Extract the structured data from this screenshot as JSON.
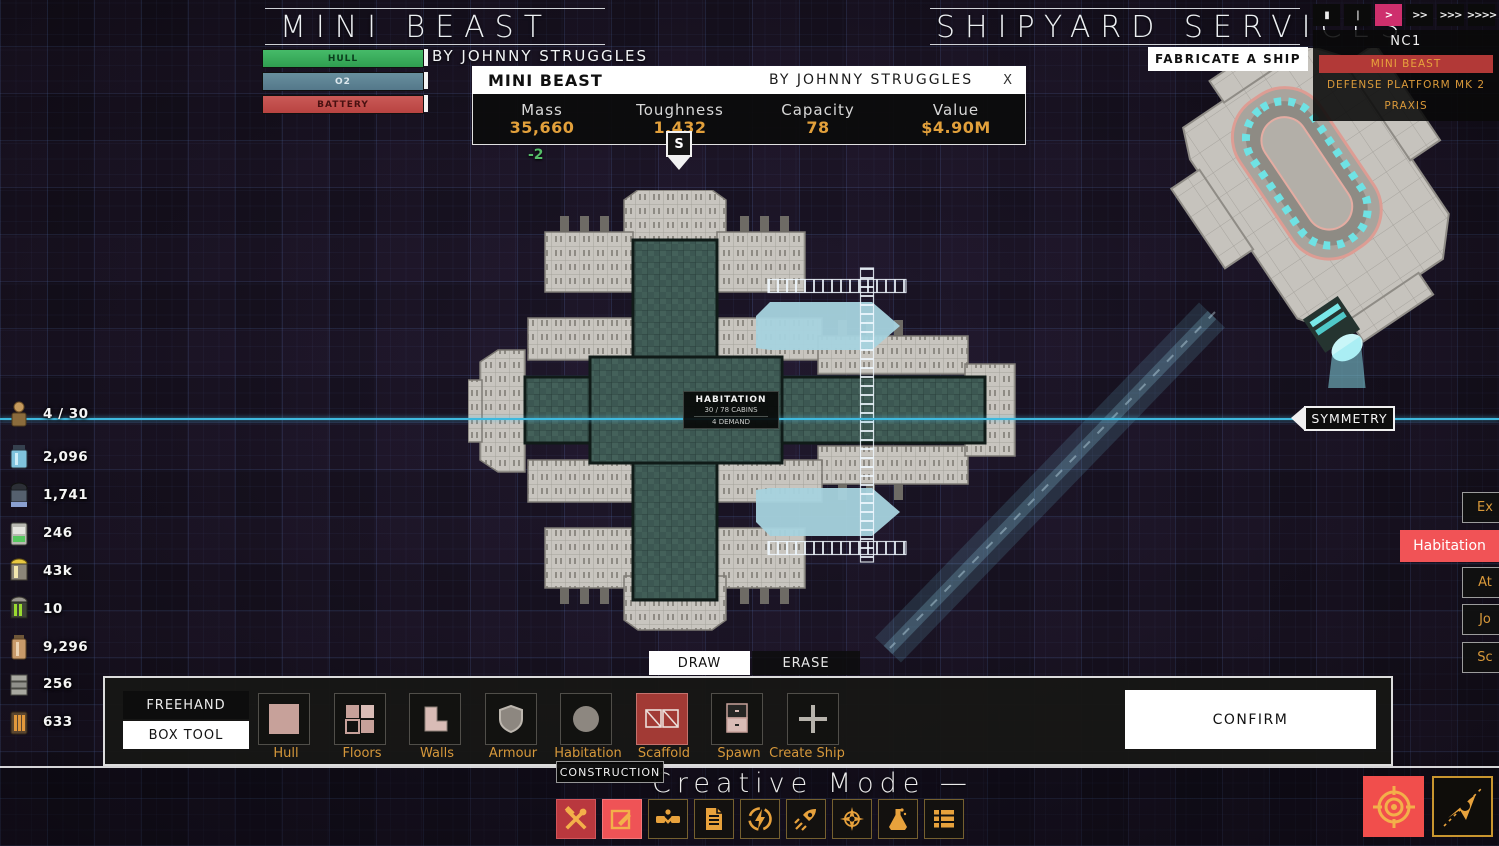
{
  "header": {
    "left_title": "MINI BEAST",
    "left_author": "BY JOHNNY STRUGGLES",
    "right_title": "SHIPYARD SERVICES",
    "fabricate": "FABRICATE A SHIP",
    "bars": [
      {
        "label": "HULL",
        "color": "#35a455"
      },
      {
        "label": "O2",
        "color": "#5a7e8e"
      },
      {
        "label": "BATTERY",
        "color": "#c04a49"
      }
    ]
  },
  "speed_controls": {
    "buttons": [
      {
        "glyph": "▮",
        "active": false
      },
      {
        "glyph": "|",
        "active": false
      },
      {
        "glyph": ">",
        "active": true
      },
      {
        "glyph": ">>",
        "active": false
      },
      {
        "glyph": ">>>",
        "active": false
      },
      {
        "glyph": ">>>>",
        "active": false
      }
    ],
    "active_color": "#ce2f6d"
  },
  "ship_list": {
    "title": "NC1",
    "items": [
      {
        "label": "MINI BEAST",
        "selected": true
      },
      {
        "label": "DEFENSE PLATFORM MK 2",
        "selected": false
      },
      {
        "label": "PRAXIS",
        "selected": false
      }
    ]
  },
  "info_dialog": {
    "title": "MINI BEAST",
    "author": "BY JOHNNY STRUGGLES",
    "close": "X",
    "stats": [
      {
        "label": "Mass",
        "value": "35,660"
      },
      {
        "label": "Toughness",
        "value": "1,432"
      },
      {
        "label": "Capacity",
        "value": "78"
      },
      {
        "label": "Value",
        "value": "$4.90M"
      }
    ],
    "delta": "-2"
  },
  "spawn_marker": "S",
  "resources": [
    {
      "icon": "crew-icon",
      "value": "4 / 30"
    },
    {
      "icon": "canister-blue-icon",
      "value": "2,096"
    },
    {
      "icon": "canister-dark-icon",
      "value": "1,741"
    },
    {
      "icon": "cell-green-icon",
      "value": "246"
    },
    {
      "icon": "barrel-yellow-icon",
      "value": "43k"
    },
    {
      "icon": "barrel-green-icon",
      "value": "10"
    },
    {
      "icon": "canister-tan-icon",
      "value": "9,296"
    },
    {
      "icon": "stack-gray-icon",
      "value": "256"
    },
    {
      "icon": "stack-orange-icon",
      "value": "633"
    }
  ],
  "symmetry_button": "SYMMETRY",
  "right_panel": {
    "habitation": "Habitation",
    "buttons": [
      {
        "label": "Ex"
      },
      {
        "label": "At"
      },
      {
        "label": "Jo"
      },
      {
        "label": "Sc"
      }
    ]
  },
  "ship_label": {
    "title": "HABITATION",
    "capacity": "30 / 78 CABINS",
    "demand": "4 DEMAND"
  },
  "draw_tabs": {
    "draw": "DRAW",
    "erase": "ERASE"
  },
  "toolbar": {
    "freehand": "FREEHAND",
    "box_tool": "BOX TOOL",
    "tools": [
      {
        "label": "Hull",
        "selected": false
      },
      {
        "label": "Floors",
        "selected": false
      },
      {
        "label": "Walls",
        "selected": false
      },
      {
        "label": "Armour",
        "selected": false
      },
      {
        "label": "Habitation",
        "selected": false
      },
      {
        "label": "Scaffold",
        "selected": true
      },
      {
        "label": "Spawn",
        "selected": false
      },
      {
        "label": "Create Ship",
        "selected": false
      }
    ],
    "confirm": "CONFIRM"
  },
  "tooltip": "CONSTRUCTION",
  "mode_text": "Creative Mode —",
  "bottom_icons": [
    {
      "name": "construction-tools-icon",
      "active": true
    },
    {
      "name": "draw-edit-icon",
      "active": true
    },
    {
      "name": "trade-handshake-icon",
      "active": false
    },
    {
      "name": "contracts-document-icon",
      "active": false
    },
    {
      "name": "power-lightning-icon",
      "active": false
    },
    {
      "name": "thrusters-rocket-icon",
      "active": false
    },
    {
      "name": "navigation-compass-icon",
      "active": false
    },
    {
      "name": "research-flask-icon",
      "active": false
    },
    {
      "name": "inventory-list-icon",
      "active": false
    }
  ],
  "colors": {
    "accent_orange": "#e8a23c",
    "accent_pink": "#ce2f6d",
    "selected_row_red": "#b23937",
    "habitation_red": "#f15356",
    "symmetry_cyan": "#3fb9de",
    "scaffold_cyan": "#a7d3de",
    "floor_teal": "#3c5752",
    "hull_gray": "#c8c5bf"
  }
}
